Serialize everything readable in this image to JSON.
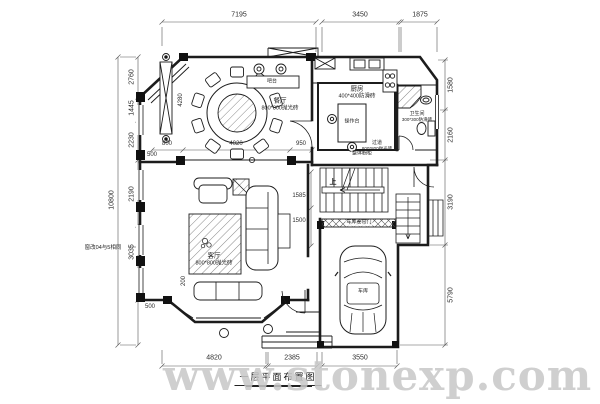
{
  "title_block": {
    "caption": "一层平面布置图",
    "watermark": "www.stonexp.com"
  },
  "dims": {
    "top": [
      "7195",
      "3450",
      "1875"
    ],
    "bottom": [
      "4820",
      "2385",
      "3550"
    ],
    "left": {
      "d2760": "2760",
      "d1445": "1445",
      "d2230": "2230",
      "d10800": "10800",
      "d2190": "2190",
      "d3035": "3035"
    },
    "right": {
      "d1580": "1580",
      "d2160": "2160",
      "d3190": "3190",
      "d5790": "5790"
    },
    "inner": {
      "d800": "800",
      "d4020": "4020",
      "d950": "950",
      "d500a": "500",
      "d4280": "4280",
      "d1585": "1585",
      "d1500": "1500",
      "d200": "200",
      "d500b": "500"
    }
  },
  "rooms": {
    "dining": {
      "name": "餐厅",
      "floor": "800*800抛光砖"
    },
    "living": {
      "name": "客厅",
      "floor": "800*800抛光砖"
    },
    "kitchen": {
      "name": "厨房",
      "floor": "400*400防滑砖"
    },
    "bath": {
      "name": "卫生间",
      "floor": "300*300防滑砖"
    },
    "hallway": {
      "name": "过道",
      "floor": "800*800抛光砖"
    },
    "garage": {
      "name": "车库"
    },
    "bar": {
      "name": "吧台"
    },
    "island": {
      "name": "操作台"
    }
  },
  "annotations": {
    "stairs_up": "上",
    "garage_door": "车库卷帘门",
    "cabinet_note": "整体橱柜",
    "window_note": "窗改04与5相同"
  },
  "colors": {
    "line": "#1c1c1c",
    "dim_line": "#555555",
    "watermark": "#c7c7c7"
  }
}
